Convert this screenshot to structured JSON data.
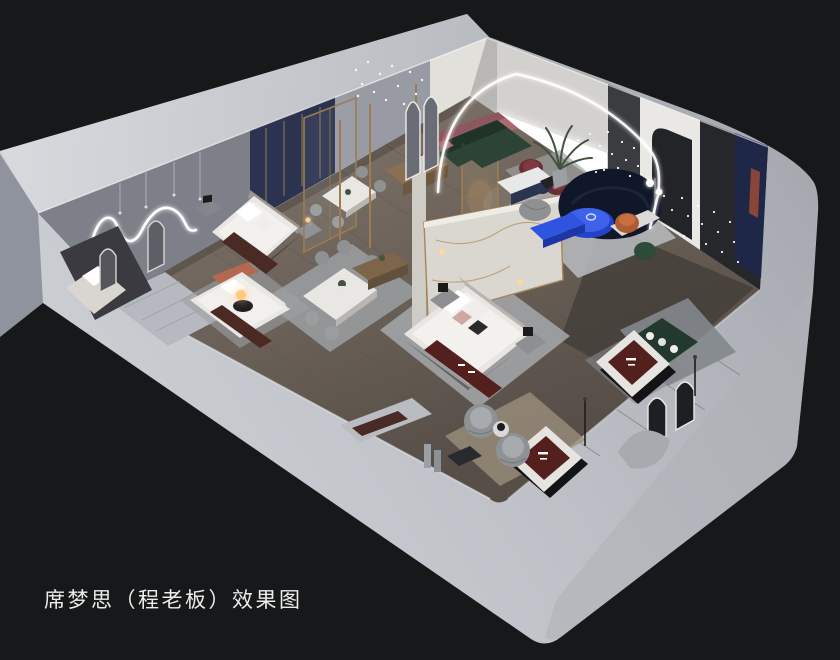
{
  "caption": {
    "text": "席梦思（程老板）效果图"
  },
  "scene": {
    "type": "isometric-cutaway-3d-interior-render",
    "subject": "mattress-showroom-floorplan",
    "areas": [
      "neon-art-room",
      "bedroom-display",
      "dining-displays",
      "lounge-with-curved-sofa",
      "fairy-light-gallery",
      "mattress-display-platforms"
    ],
    "palette": {
      "background": "#17181a",
      "slab_light": "#cdd0d5",
      "slab_dark": "#a9adb2",
      "exterior_wall": "#8f939e",
      "interior_wall_grey": "#7d8089",
      "floor_wood": "#6e645b",
      "marble": "#dad6d0",
      "gold_trim": "#9c7c50",
      "navy_panel": "#2c3350",
      "sofa_navy": "#0f1728",
      "sofa_green": "#2b4435",
      "bench_pink": "#a96a70",
      "chair_maroon": "#6b2e34",
      "chair_orange": "#b05c33",
      "accent_blue": "#2f55e0",
      "mattress_burgundy": "#54201d",
      "led_white": "#ffffff",
      "lamp_warm": "#ffc87a"
    }
  }
}
